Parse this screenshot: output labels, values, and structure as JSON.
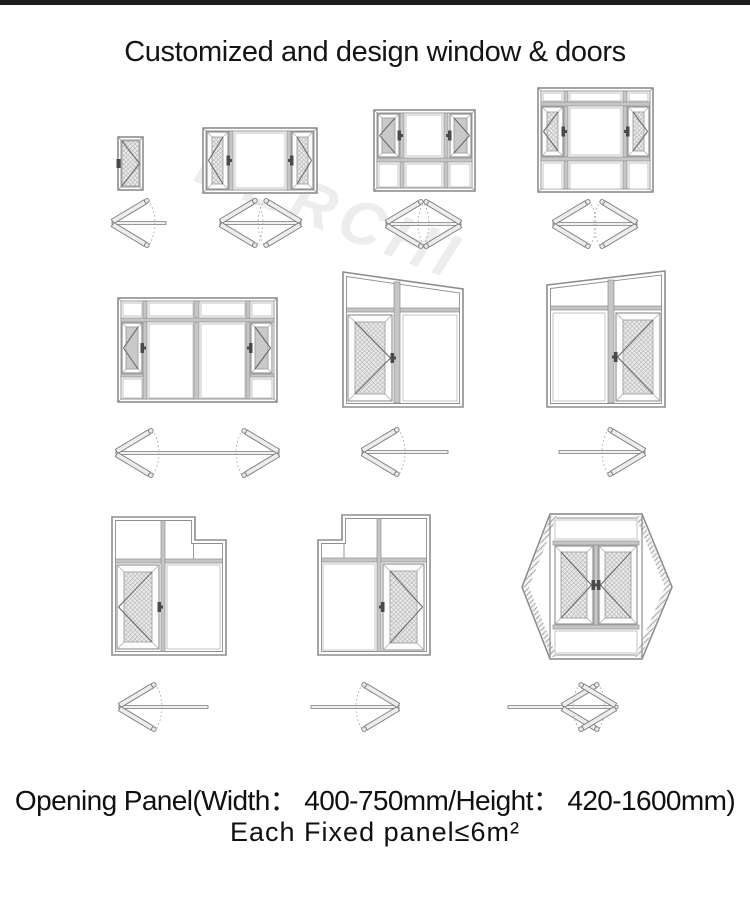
{
  "page": {
    "title": "Customized and design window & doors",
    "watermark": "DERCHI",
    "footer_line1": "Opening Panel(Width： 400-750mm/Height： 420-1600mm)",
    "footer_line2": "Each Fixed panel≤6m²"
  },
  "colors": {
    "top_bar": "#1d1d1d",
    "line": "#8e8e8e",
    "dark_line": "#6b6b6b",
    "mullion_fill": "#c6c6c6",
    "mesh_bg": "#eaeaea",
    "mesh_line": "#b2b2b2",
    "glass_gray": "#c9c9c9",
    "handle": "#4a4a4a",
    "arrow_bar": "#ededed",
    "arrow_line": "#7c7c7c"
  },
  "figures": [
    {
      "name": "single-casement-door-icon"
    },
    {
      "name": "two-side-casements-fixed-center-window-icon"
    },
    {
      "name": "two-casement-window-bottom-fixed-icon"
    },
    {
      "name": "casement-window-transom-and-bottom-fixed-icon"
    },
    {
      "name": "wide-window-side-casements-icon"
    },
    {
      "name": "raked-top-door-left-opening-icon"
    },
    {
      "name": "raked-top-door-right-opening-icon"
    },
    {
      "name": "stepped-top-door-left-opening-icon"
    },
    {
      "name": "stepped-top-door-right-opening-icon"
    },
    {
      "name": "hexagon-double-casement-window-icon"
    }
  ],
  "arrows": [
    {
      "name": "swing-arrow-left-icon"
    },
    {
      "name": "swing-arrow-double-icon"
    },
    {
      "name": "swing-arrow-double-icon"
    },
    {
      "name": "swing-arrow-double-icon"
    },
    {
      "name": "swing-arrow-double-wide-icon"
    },
    {
      "name": "swing-arrow-left-icon"
    },
    {
      "name": "swing-arrow-right-icon"
    },
    {
      "name": "swing-arrow-left-icon"
    },
    {
      "name": "swing-arrow-right-icon"
    },
    {
      "name": "swing-arrow-center-double-icon"
    }
  ]
}
